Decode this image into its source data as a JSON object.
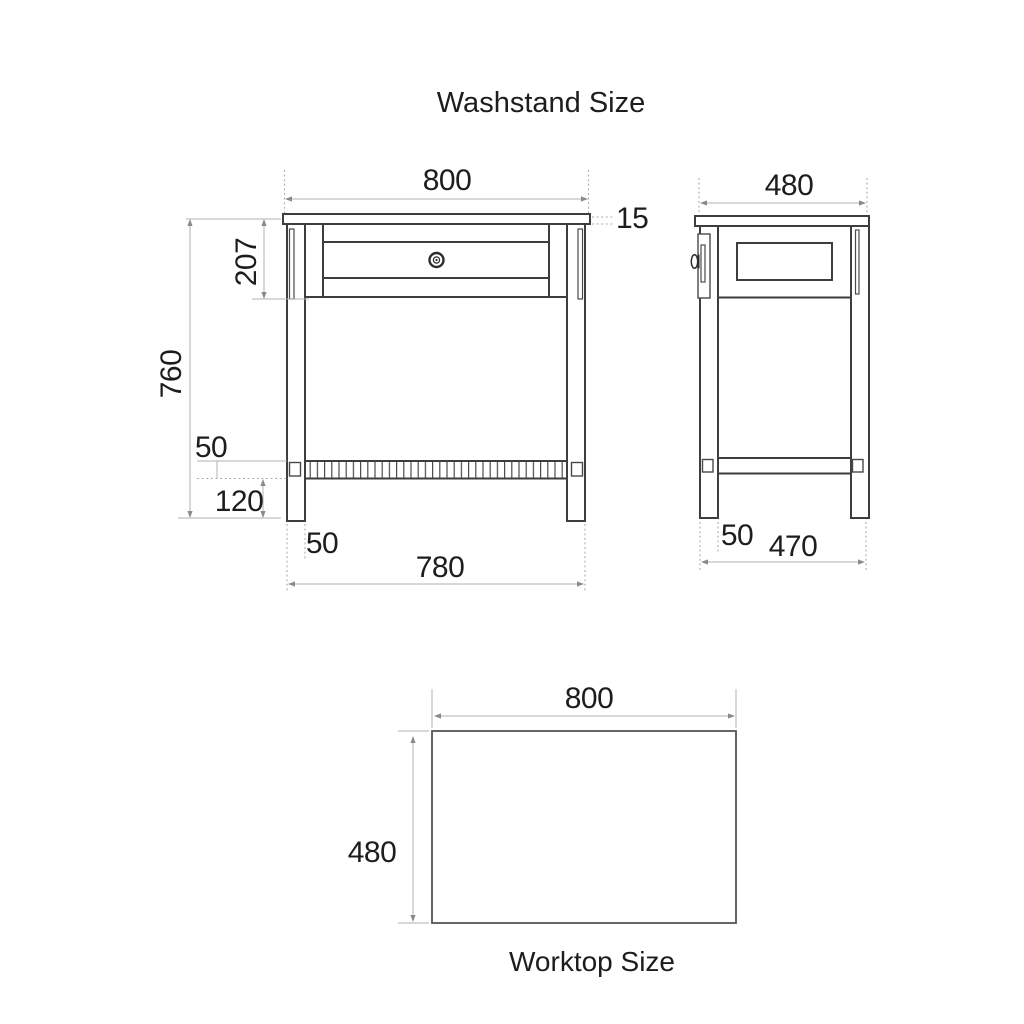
{
  "title": "Washstand Size",
  "front_view": {
    "top_width": "800",
    "top_thickness": "15",
    "drawer_height": "207",
    "overall_height": "760",
    "shelf_thickness": "50",
    "shelf_clearance": "120",
    "leg_width": "50",
    "base_width": "780"
  },
  "side_view": {
    "top_depth": "480",
    "leg_width": "50",
    "base_depth": "470"
  },
  "worktop": {
    "width": "800",
    "depth": "480",
    "caption": "Worktop Size"
  },
  "colors": {
    "background": "#ffffff",
    "drawing_line": "#3e3e3e",
    "dimension_line": "#b2b2b2",
    "text": "#1d1d1d"
  }
}
